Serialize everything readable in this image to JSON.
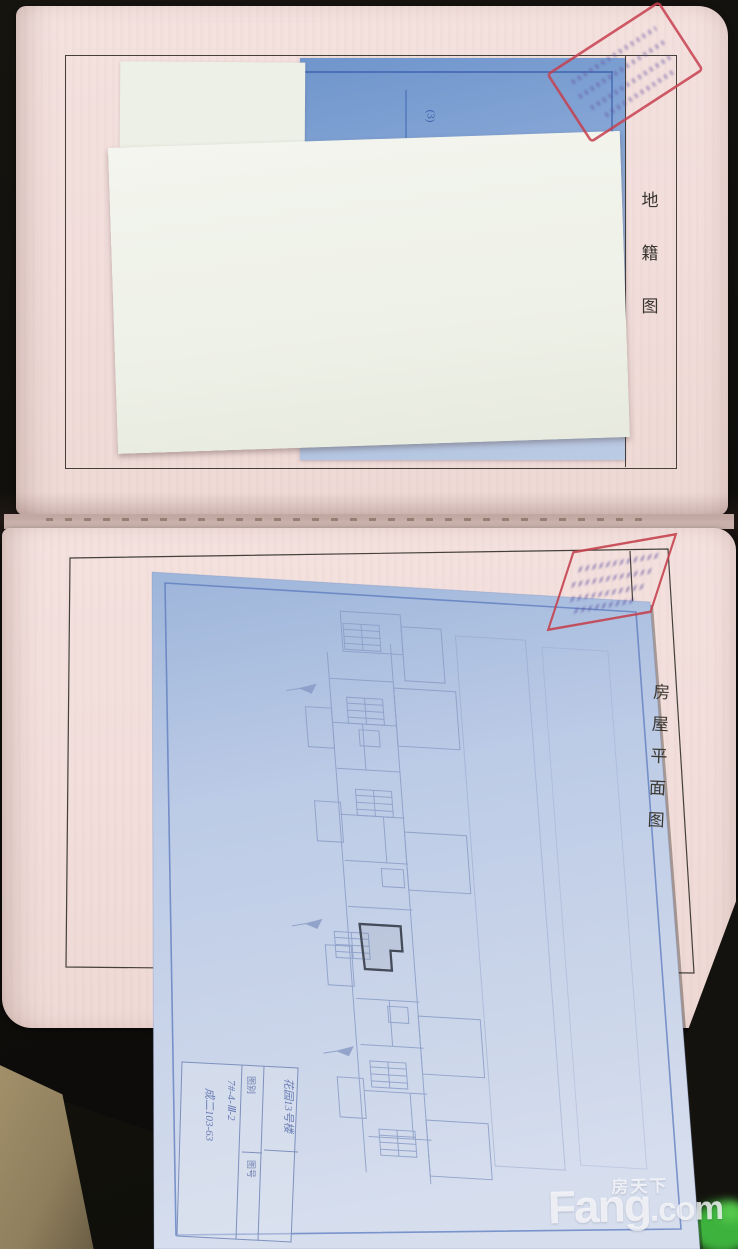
{
  "top_page": {
    "side_label": "地籍图",
    "chars": [
      "地",
      "籍",
      "图"
    ]
  },
  "bottom_page": {
    "side_label": "房屋平面图",
    "chars": [
      "房",
      "屋",
      "平",
      "面",
      "图"
    ]
  },
  "blue_paper": {
    "corner_note": "(3)"
  },
  "blueprint": {
    "title_block": {
      "rows": [
        {
          "label": "图别",
          "value": "花园13号楼"
        },
        {
          "label": "图号",
          "value": "7#-4-Ⅲ-2"
        },
        {
          "label": "比例",
          "value": "成二103-63"
        }
      ]
    }
  },
  "watermark": {
    "cn": "房天下",
    "en_main": "Fang",
    "en_suffix": ".com"
  },
  "colors": {
    "background": "#13110d",
    "page_pink": "#f3e1de",
    "map_blue": "#87a7d6",
    "blueprint_blue": "#c2cfe8",
    "plan_line_blue": "#8a9cc6",
    "frame_line": "#45403a",
    "stamp_red": "#c7404f",
    "stamp_purple": "#64519f",
    "watermark_white": "#fafafc",
    "fabric_tan": "#a4926c",
    "green_object": "#3db23c"
  }
}
